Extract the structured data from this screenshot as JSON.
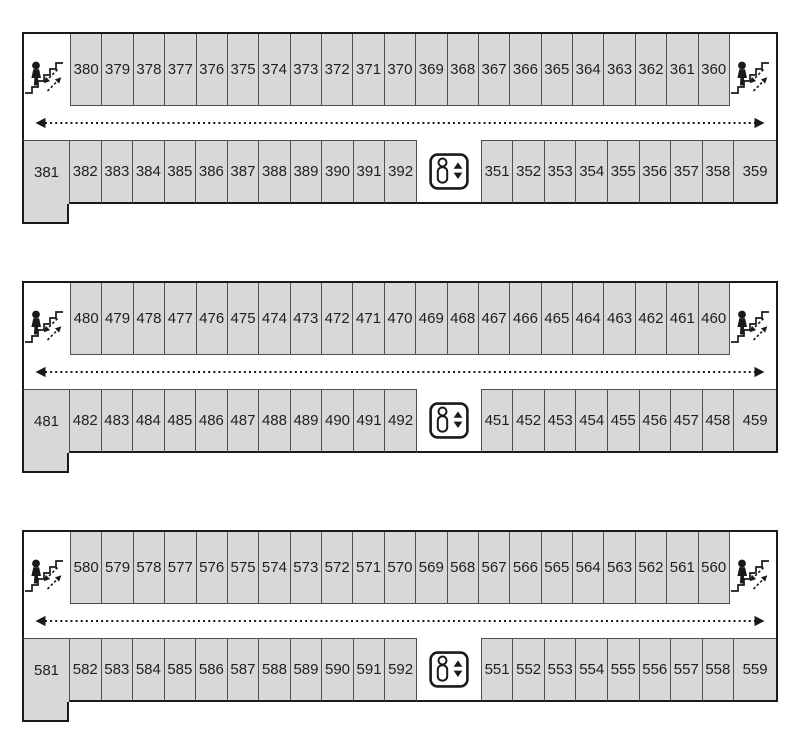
{
  "colors": {
    "room_fill": "#d8d8d8",
    "outer_border": "#1a1a1a",
    "inner_border": "#4f4f4f",
    "text": "#1f1f1f",
    "background": "#ffffff"
  },
  "icons": {
    "stairs": "stairs-icon",
    "elevator": "elevator-icon",
    "corridor_arrow": "dotted-double-arrow-icon"
  },
  "floors": [
    {
      "id": "3xx",
      "top_rooms": [
        "380",
        "379",
        "378",
        "377",
        "376",
        "375",
        "374",
        "373",
        "372",
        "371",
        "370",
        "369",
        "368",
        "367",
        "366",
        "365",
        "364",
        "363",
        "362",
        "361",
        "360"
      ],
      "bottom_left_end": "381",
      "bottom_left_rooms": [
        "382",
        "383",
        "384",
        "385",
        "386",
        "387",
        "388",
        "389",
        "390",
        "391",
        "392"
      ],
      "bottom_right_rooms": [
        "351",
        "352",
        "353",
        "354",
        "355",
        "356",
        "357",
        "358"
      ],
      "bottom_right_end": "359"
    },
    {
      "id": "4xx",
      "top_rooms": [
        "480",
        "479",
        "478",
        "477",
        "476",
        "475",
        "474",
        "473",
        "472",
        "471",
        "470",
        "469",
        "468",
        "467",
        "466",
        "465",
        "464",
        "463",
        "462",
        "461",
        "460"
      ],
      "bottom_left_end": "481",
      "bottom_left_rooms": [
        "482",
        "483",
        "484",
        "485",
        "486",
        "487",
        "488",
        "489",
        "490",
        "491",
        "492"
      ],
      "bottom_right_rooms": [
        "451",
        "452",
        "453",
        "454",
        "455",
        "456",
        "457",
        "458"
      ],
      "bottom_right_end": "459"
    },
    {
      "id": "5xx",
      "top_rooms": [
        "580",
        "579",
        "578",
        "577",
        "576",
        "575",
        "574",
        "573",
        "572",
        "571",
        "570",
        "569",
        "568",
        "567",
        "566",
        "565",
        "564",
        "563",
        "562",
        "561",
        "560"
      ],
      "bottom_left_end": "581",
      "bottom_left_rooms": [
        "582",
        "583",
        "584",
        "585",
        "586",
        "587",
        "588",
        "589",
        "590",
        "591",
        "592"
      ],
      "bottom_right_rooms": [
        "551",
        "552",
        "553",
        "554",
        "555",
        "556",
        "557",
        "558"
      ],
      "bottom_right_end": "559"
    }
  ]
}
